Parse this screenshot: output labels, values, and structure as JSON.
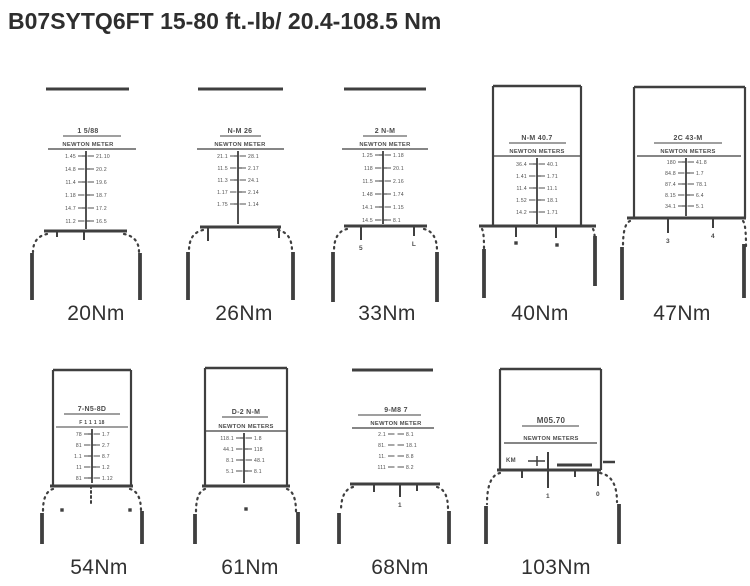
{
  "title": "B07SYTQ6FT 15-80 ft.-lb/ 20.4-108.5 Nm",
  "ink": "#3f3f3f",
  "ink_text": "#4c4c4c",
  "window_text_note": "blurred scan micro-text",
  "figures": [
    {
      "label": "20Nm",
      "cx": 88,
      "label_cx": 96,
      "label_top": 302,
      "bar": [
        46,
        129,
        89
      ],
      "h1": {
        "t": "1 5/88",
        "y": 133,
        "ul": [
          63,
          121
        ]
      },
      "h2": {
        "t": "NEWTON METER",
        "y": 146,
        "ul": [
          48,
          136
        ]
      },
      "vline": {
        "x": 86,
        "y1": 151,
        "y2": 229
      },
      "rows": {
        "y0": 158,
        "step": 13,
        "vx": 86,
        "items": [
          [
            "1.45",
            "21.10"
          ],
          [
            "14.8",
            "20.2"
          ],
          [
            "11.4",
            "19.6"
          ],
          [
            "1.18",
            "18.7"
          ],
          [
            "14.7",
            "17.2"
          ],
          [
            "11.2",
            "16.5"
          ]
        ]
      },
      "head": [
        44,
        127,
        231
      ],
      "subticks": [
        {
          "x": 57,
          "len": 6
        },
        {
          "x": 84,
          "len": 9
        }
      ],
      "shoulders": [
        [
          47,
          234,
          33,
          252
        ],
        [
          124,
          234,
          139,
          252
        ]
      ],
      "handles": [
        [
          32,
          253,
          300
        ],
        [
          140,
          253,
          300
        ]
      ]
    },
    {
      "label": "26Nm",
      "cx": 240,
      "label_cx": 244,
      "label_top": 302,
      "bar": [
        198,
        283,
        89
      ],
      "h1": {
        "t": "N-M 26",
        "y": 133,
        "ul": [
          220,
          261
        ]
      },
      "h2": {
        "t": "NEWTON METER",
        "y": 146,
        "ul": [
          197,
          284
        ]
      },
      "vline": {
        "x": 238,
        "y1": 151,
        "y2": 224
      },
      "rows": {
        "y0": 158,
        "step": 12,
        "vx": 238,
        "items": [
          [
            "21.1",
            "28.1"
          ],
          [
            "11.5",
            "2.17"
          ],
          [
            "11.3",
            "24.1"
          ],
          [
            "1.17",
            "2.14"
          ],
          [
            "1.75",
            "1.14"
          ]
        ]
      },
      "head": [
        200,
        281,
        227
      ],
      "subticks": [
        {
          "x": 208,
          "len": 14
        },
        {
          "x": 279,
          "len": 11
        }
      ],
      "shoulders": [
        [
          203,
          230,
          189,
          251
        ],
        [
          278,
          230,
          292,
          251
        ]
      ],
      "handles": [
        [
          188,
          252,
          300
        ],
        [
          293,
          252,
          300
        ]
      ]
    },
    {
      "label": "33Nm",
      "cx": 385,
      "label_cx": 387,
      "label_top": 302,
      "bar": [
        344,
        426,
        89
      ],
      "h1": {
        "t": "2 N-M",
        "y": 133,
        "ul": [
          363,
          407
        ]
      },
      "h2": {
        "t": "NEWTON METER",
        "y": 146,
        "ul": [
          342,
          428
        ]
      },
      "vline": {
        "x": 383,
        "y1": 151,
        "y2": 224
      },
      "rows": {
        "y0": 157,
        "step": 13,
        "vx": 383,
        "items": [
          [
            "1.25",
            "1.18"
          ],
          [
            "118",
            "20.1"
          ],
          [
            "11.5",
            "2.16"
          ],
          [
            "1.48",
            "1.74"
          ],
          [
            "14.1",
            "1.15"
          ],
          [
            "14.5",
            "8.1"
          ]
        ]
      },
      "head": [
        344,
        427,
        226
      ],
      "subticks": [
        {
          "x": 361,
          "len": 14,
          "label": "5"
        },
        {
          "x": 414,
          "len": 10,
          "label": "L"
        }
      ],
      "shoulders": [
        [
          347,
          229,
          334,
          251
        ],
        [
          424,
          229,
          437,
          251
        ]
      ],
      "handles": [
        [
          333,
          252,
          302
        ],
        [
          437,
          252,
          302
        ]
      ]
    },
    {
      "label": "40Nm",
      "cx": 537,
      "label_cx": 540,
      "label_top": 302,
      "rect": [
        493,
        581,
        86
      ],
      "h1": {
        "t": "N-M 40.7",
        "y": 140,
        "ul": [
          509,
          566
        ]
      },
      "h2": {
        "t": "NEWTON METERS",
        "y": 153,
        "ul": [
          494,
          580
        ]
      },
      "vline": {
        "x": 537,
        "y1": 158,
        "y2": 224
      },
      "rows": {
        "y0": 166,
        "step": 12,
        "vx": 537,
        "items": [
          [
            "36.4",
            "40.1"
          ],
          [
            "1.41",
            "1.71"
          ],
          [
            "11.4",
            "11.1"
          ],
          [
            "1.52",
            "18.1"
          ],
          [
            "14.2",
            "1.71"
          ]
        ]
      },
      "head": [
        479,
        596,
        226
      ],
      "subticks": [
        {
          "x": 516,
          "len": 11
        },
        {
          "x": 556,
          "len": 12
        }
      ],
      "dots": [
        [
          516,
          243
        ],
        [
          557,
          245
        ]
      ],
      "shoulders": [
        [
          482,
          229,
          484,
          248
        ],
        [
          593,
          229,
          595,
          246
        ]
      ],
      "handles": [
        [
          484,
          249,
          298
        ],
        [
          595,
          236,
          286
        ]
      ]
    },
    {
      "label": "47Nm",
      "cx": 688,
      "label_cx": 682,
      "label_top": 302,
      "rect": [
        634,
        745,
        87
      ],
      "h1": {
        "t": "2C 43-M",
        "y": 140,
        "ul": [
          654,
          722
        ]
      },
      "h2": {
        "t": "NEWTON METERS",
        "y": 153,
        "ul": [
          637,
          741
        ]
      },
      "vline": {
        "x": 686,
        "y1": 158,
        "y2": 216
      },
      "rows": {
        "y0": 164,
        "step": 11,
        "vx": 686,
        "items": [
          [
            "180",
            "41.8"
          ],
          [
            "84.8",
            "1.7"
          ],
          [
            "87.4",
            "78.1"
          ],
          [
            "8.15",
            "6.4"
          ],
          [
            "34.1",
            "5.1"
          ]
        ]
      },
      "head": [
        627,
        746,
        218
      ],
      "subticks": [
        {
          "x": 668,
          "len": 15,
          "label": "3"
        },
        {
          "x": 713,
          "len": 10,
          "label": "4"
        }
      ],
      "shoulders": [
        [
          630,
          221,
          623,
          246
        ],
        [
          743,
          221,
          746,
          246
        ]
      ],
      "handles": [
        [
          622,
          247,
          300
        ],
        [
          744,
          244,
          298
        ]
      ]
    },
    {
      "label": "54Nm",
      "cx": 92,
      "label_cx": 99,
      "label_top": 556,
      "rect": [
        53,
        131,
        370
      ],
      "h1": {
        "t": "7-N5-8D",
        "y": 411,
        "ul": [
          64,
          120
        ]
      },
      "line3": {
        "t": "F 1 1 1 18",
        "y": 424,
        "ul": [
          56,
          128
        ]
      },
      "vline": {
        "x": 92,
        "y1": 429,
        "y2": 483
      },
      "rows": {
        "y0": 436,
        "step": 11,
        "vx": 92,
        "items": [
          [
            "78",
            "1.7"
          ],
          [
            "81",
            "2.7"
          ],
          [
            "1.1",
            "8.7"
          ],
          [
            "11",
            "1.2"
          ],
          [
            "81",
            "1.12"
          ]
        ]
      },
      "head": [
        50,
        133,
        486
      ],
      "subticks": [
        {
          "x": 91,
          "len": 18,
          "dotted": true
        }
      ],
      "dots": [
        [
          62,
          510
        ],
        [
          130,
          510
        ]
      ],
      "shoulders": [
        [
          53,
          489,
          43,
          511
        ],
        [
          130,
          489,
          141,
          511
        ]
      ],
      "handles": [
        [
          42,
          513,
          544
        ],
        [
          142,
          511,
          544
        ]
      ]
    },
    {
      "label": "61Nm",
      "cx": 246,
      "label_cx": 250,
      "label_top": 556,
      "rect": [
        205,
        287,
        368
      ],
      "h1": {
        "t": "D-2 N-M",
        "y": 414,
        "ul": [
          222,
          268
        ]
      },
      "h2": {
        "t": "NEWTON METERS",
        "y": 428,
        "ul": [
          206,
          286
        ]
      },
      "vline": {
        "x": 244,
        "y1": 433,
        "y2": 483
      },
      "rows": {
        "y0": 440,
        "step": 11,
        "vx": 244,
        "items": [
          [
            "118.1",
            "1.8"
          ],
          [
            "44.1",
            "118"
          ],
          [
            "8.1",
            "48.1"
          ],
          [
            "5.1",
            "8.1"
          ]
        ]
      },
      "head": [
        202,
        290,
        486
      ],
      "dots": [
        [
          246,
          509
        ]
      ],
      "shoulders": [
        [
          205,
          489,
          196,
          512
        ],
        [
          287,
          489,
          296,
          512
        ]
      ],
      "handles": [
        [
          195,
          514,
          544
        ],
        [
          298,
          512,
          544
        ]
      ]
    },
    {
      "label": "68Nm",
      "cx": 396,
      "label_cx": 400,
      "label_top": 556,
      "bar": [
        352,
        433,
        370
      ],
      "h1": {
        "t": "9-M8 7",
        "y": 412,
        "ul": [
          358,
          421
        ]
      },
      "h2": {
        "t": "NEWTON METER",
        "y": 425,
        "ul": [
          352,
          434
        ]
      },
      "rows": {
        "y0": 436,
        "step": 11,
        "vx": 396,
        "items": [
          [
            "2.1",
            "8.1"
          ],
          [
            "81.",
            "18.1"
          ],
          [
            "11.",
            "8.8"
          ],
          [
            "111",
            "8.2"
          ]
        ]
      },
      "head": [
        350,
        440,
        484
      ],
      "subticks": [
        {
          "x": 374,
          "len": 8
        },
        {
          "x": 400,
          "len": 13,
          "label": "1"
        },
        {
          "x": 417,
          "len": 7
        }
      ],
      "shoulders": [
        [
          353,
          487,
          341,
          511
        ],
        [
          437,
          487,
          448,
          509
        ]
      ],
      "handles": [
        [
          339,
          513,
          544
        ],
        [
          449,
          511,
          544
        ]
      ]
    },
    {
      "label": "103Nm",
      "cx": 551,
      "label_cx": 556,
      "label_top": 556,
      "rect": [
        500,
        601,
        369
      ],
      "h1": {
        "t": "M05.70",
        "y": 423,
        "fs": 8,
        "ul": [
          522,
          579
        ]
      },
      "h2": {
        "t": "NEWTON METERS",
        "y": 440,
        "ul": [
          504,
          597
        ]
      },
      "hscale": {
        "label": "KM",
        "lx": 506,
        "ly": 462,
        "line": [
          528,
          545,
          461
        ],
        "ltick": [
          537,
          456,
          466
        ],
        "utick": [
          548,
          452,
          470
        ],
        "dash": [
          557,
          592,
          465
        ],
        "odash": [
          603,
          615,
          462
        ]
      },
      "head": [
        497,
        601,
        470
      ],
      "subticks": [
        {
          "x": 522,
          "len": 8
        },
        {
          "x": 548,
          "len": 18,
          "label": "1"
        },
        {
          "x": 575,
          "len": 7
        },
        {
          "x": 598,
          "len": 16,
          "label": "0"
        }
      ],
      "shoulders": [
        [
          500,
          473,
          487,
          504
        ],
        [
          600,
          473,
          617,
          502
        ]
      ],
      "handles": [
        [
          486,
          506,
          544
        ],
        [
          619,
          504,
          544
        ]
      ]
    }
  ]
}
